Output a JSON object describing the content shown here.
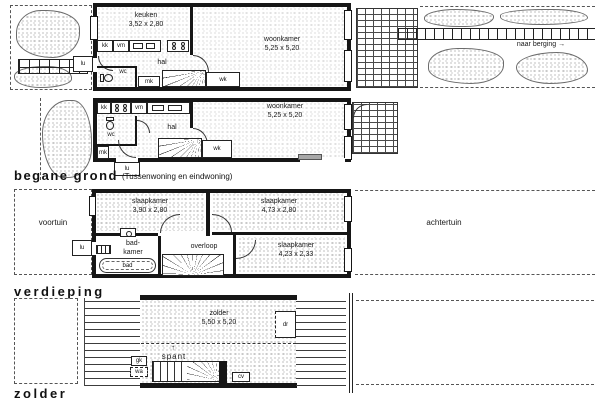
{
  "captions": {
    "ground": "begane grond",
    "ground_note": "(Tussenwoning en eindwoning)",
    "floor": "verdieping",
    "attic": "zolder"
  },
  "ground_end": {
    "keuken": "keuken",
    "keuken_dims": "3,52 x 2,80",
    "woonkamer": "woonkamer",
    "woonkamer_dims": "5,25 x 5,20",
    "hal": "hal",
    "wc": "wc",
    "mk": "mk",
    "wk": "wk",
    "kk": "kk",
    "vm": "vm",
    "lu": "lu",
    "garden_note": "naar berging",
    "arrow_right": "→"
  },
  "ground_mid": {
    "woonkamer": "woonkamer",
    "woonkamer_dims": "5,25 x 5,20",
    "hal": "hal",
    "wc": "wc",
    "mk": "mk",
    "wk": "wk",
    "kk": "kk",
    "vm": "vm",
    "lu": "lu"
  },
  "floor": {
    "voortuin": "voortuin",
    "achtertuin": "achtertuin",
    "slaapkamer1": "slaapkamer",
    "slaapkamer1_dims": "3,90 x 2,80",
    "slaapkamer2": "slaapkamer",
    "slaapkamer2_dims": "4,73 x 2,80",
    "slaapkamer3": "slaapkamer",
    "slaapkamer3_dims": "4,23 x 2,33",
    "badkamer_l1": "bad-",
    "badkamer_l2": "kamer",
    "overloop": "overloop",
    "bad": "bad",
    "lu": "lu"
  },
  "attic": {
    "zolder": "zolder",
    "zolder_dims": "5,50 x 5,20",
    "spant": "spant",
    "arrow_up": "↑",
    "dr": "dr",
    "gk": "gk",
    "wa": "wa",
    "cv": "cv"
  }
}
